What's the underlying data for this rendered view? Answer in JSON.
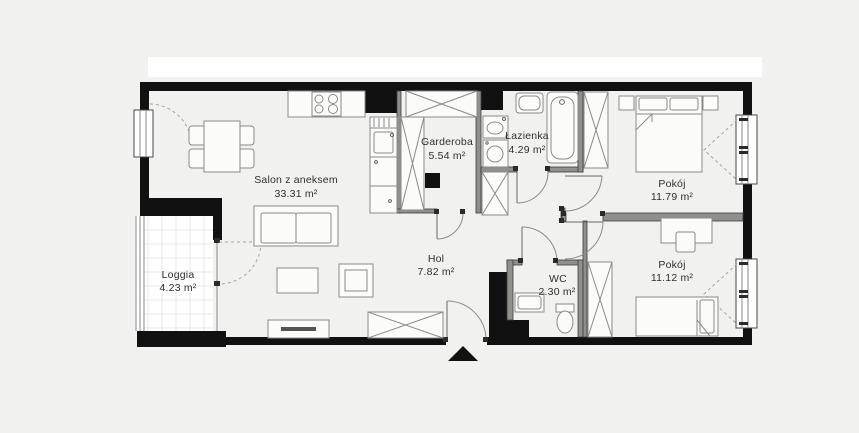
{
  "plan": {
    "colors": {
      "background": "#f1f1ef",
      "top_band": "#ffffff",
      "wall": "#111111",
      "partition": "#8f8f8c",
      "furniture_line": "#8a8a8a",
      "label_text": "#2f2f2f"
    },
    "rooms": [
      {
        "id": "salon",
        "name": "Salon z aneksem",
        "area": "33.31 m²"
      },
      {
        "id": "garderoba",
        "name": "Garderoba",
        "area": "5.54 m²"
      },
      {
        "id": "lazienka",
        "name": "Łazienka",
        "area": "4.29 m²"
      },
      {
        "id": "pokoj-1",
        "name": "Pokój",
        "area": "11.79 m²"
      },
      {
        "id": "pokoj-2",
        "name": "Pokój",
        "area": "11.12 m²"
      },
      {
        "id": "hol",
        "name": "Hol",
        "area": "7.82 m²"
      },
      {
        "id": "wc",
        "name": "WC",
        "area": "2.30 m²"
      },
      {
        "id": "loggia",
        "name": "Loggia",
        "area": "4.23 m²"
      }
    ]
  }
}
